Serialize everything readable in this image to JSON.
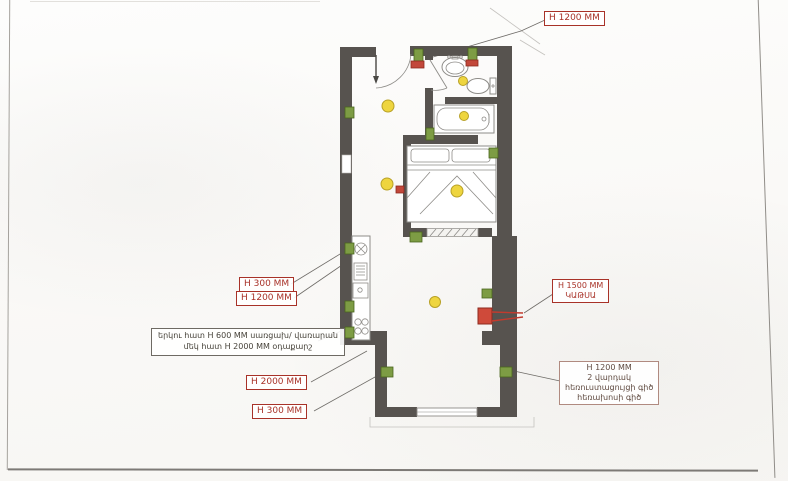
{
  "document": {
    "kind": "scanned apartment floor plan with electrical layout",
    "language": "Armenian"
  },
  "colors": {
    "wall": "#57534f",
    "light_fill": "#eed53f",
    "light_stroke": "#b8a126",
    "outlet_fill": "#7d9c44",
    "outlet_stroke": "#4a661f",
    "switch_fill": "#c2473a",
    "switch_stroke": "#8e2a1f",
    "boiler_fill": "#cf4a3a",
    "pipe_red": "#c23b2e",
    "label_red": "#a83228",
    "note_border": "#6e6a63",
    "note_text": "#47433a",
    "leader": "#6f6c68",
    "fixture_stroke": "#8e8c88"
  },
  "annotations": {
    "top_height": {
      "label": "H 1200 MM"
    },
    "kitchen_heights": [
      {
        "label": "H 300 MM"
      },
      {
        "label": "H 1200 MM"
      }
    ],
    "appliance_note": {
      "line1": "երկու հատ H 600 MM  սառցախ/ վառարան",
      "line2": "մեկ հատ  H 2000  MM օդաքարշ"
    },
    "bottom_heights": [
      {
        "label": "H 2000 MM"
      },
      {
        "label": "H 300 MM"
      }
    ],
    "boiler_label": {
      "line1": "H 1500 MM",
      "line2": "ԿԱԹՍԱ"
    },
    "sockets_label": {
      "line1": "H 1200 MM",
      "line2": "2 վարդակ",
      "line3": "հեռուստացույցի գիծ",
      "line4": "հեռախոսի գիծ"
    }
  },
  "plan": {
    "rooms": [
      "entry-hall",
      "bathroom",
      "bathtub-room",
      "bedroom",
      "kitchen-living",
      "balcony"
    ],
    "fixtures": [
      "entry-door",
      "bathroom-door",
      "wash-basin",
      "toilet",
      "bathtub",
      "double-bed",
      "kitchen-counter",
      "cooktop",
      "kitchen-sink",
      "boiler",
      "window"
    ],
    "symbol_counts": {
      "ceiling_lights": 6,
      "outlets_green": 12,
      "switches_red": 3,
      "boiler_red": 1
    }
  }
}
